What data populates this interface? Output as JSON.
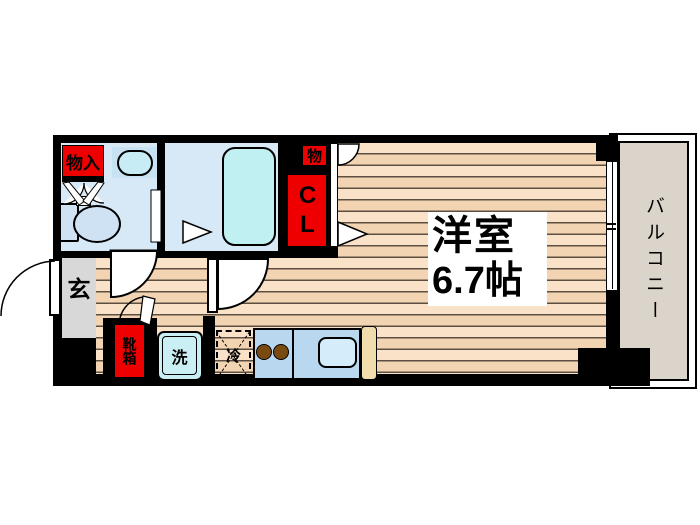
{
  "floorplan": {
    "rooms": {
      "main_room": {
        "label_line1": "洋室",
        "label_line2": "6.7帖"
      },
      "balcony": {
        "label": "バルコニー"
      },
      "entrance": {
        "label": "玄"
      }
    },
    "fixtures": {
      "shoe_box": "靴箱",
      "washer": "洗",
      "fridge": "冷",
      "storage_entrance": "物入",
      "storage_upper": "物",
      "closet": "CL"
    },
    "colors": {
      "wall_black": "#000000",
      "accent_red": "#ee0000",
      "wet_room_blue": "#d7e8f6",
      "fixture_cyan": "#c2eff2",
      "flooring_light": "#f9e2c8",
      "flooring_dark": "#f3d4b2",
      "balcony_beige": "#dbd4ca",
      "entrance_gray": "#d8d8d8",
      "kitchen_counter_blue": "#b9d8f0",
      "sink_blue": "#d5edfa",
      "burner_brown": "#7a4b10",
      "counter_end_cream": "#f0dcac"
    }
  }
}
